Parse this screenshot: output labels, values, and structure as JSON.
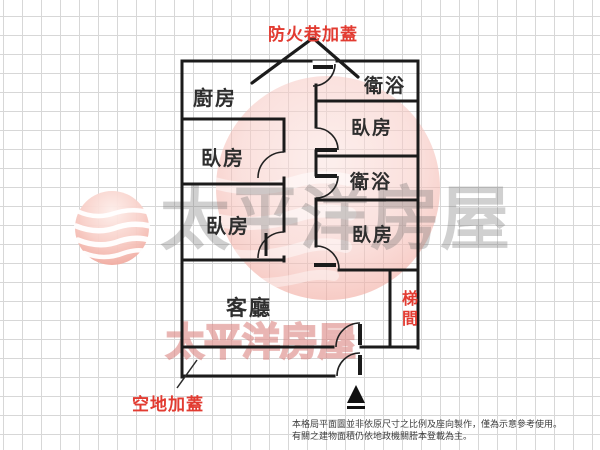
{
  "title": "房屋平面格局圖",
  "annotations": {
    "fire_lane": "防火巷加蓋",
    "vacant_lot": "空地加蓋"
  },
  "rooms": {
    "kitchen": "廚房",
    "bathroom_top": "衛浴",
    "bedroom_right_top": "臥房",
    "bathroom_middle": "衛浴",
    "bedroom_right_bottom": "臥房",
    "bedroom_left_middle": "臥房",
    "bedroom_left_bottom": "臥房",
    "living_room": "客廳",
    "stairwell": "梯間"
  },
  "watermark": {
    "brand": "太平洋房屋"
  },
  "disclaimer": {
    "line1": "本格局平面圖並非依原尺寸之比例及座向製作，僅為示意參考使用。",
    "line2": "有關之建物面積仍依地政機關謄本登載為主。"
  },
  "colors": {
    "wall": "#1b1b1b",
    "annotation_red": "#e23b31",
    "grid": "#d7d7d7",
    "watermark_pink": "#f1a99e",
    "watermark_gray": "#6e6e6e",
    "label_text": "#2e2e2e"
  }
}
